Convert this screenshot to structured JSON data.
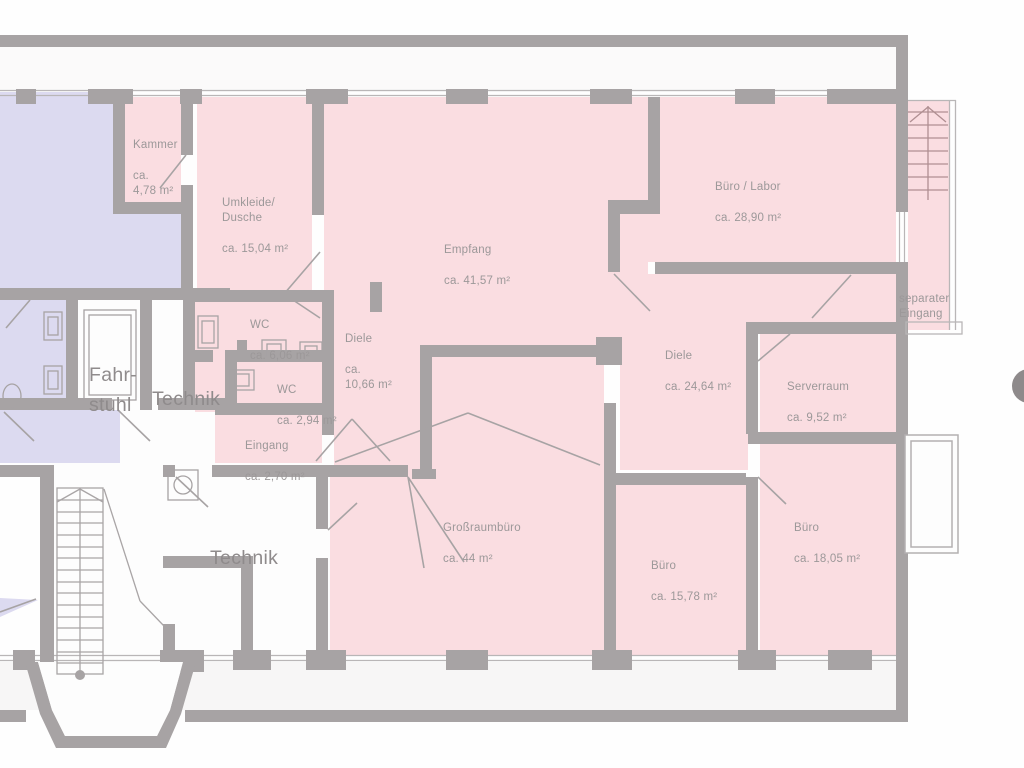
{
  "plan": {
    "type": "floor-plan",
    "language": "de",
    "highlight_note": "pink rooms = offered unit, lavender rooms = neighbouring unit, white rooms = common areas"
  },
  "colors": {
    "unit_pink": "#fadde1",
    "neighbour_lavender": "#dcdaf0",
    "wall_gray": "#a7a3a4",
    "thin_line_gray": "#b9b6b7",
    "terrace_gray": "#f7f6f6",
    "label_gray": "#9c9899",
    "big_label_gray": "#8f8b8c",
    "compass_gray": "#8e8a8b"
  },
  "rooms": [
    {
      "id": "kammer",
      "name": "Kammer",
      "area": "ca.\n4,78 m²"
    },
    {
      "id": "umkleide-dusche",
      "name": "Umkleide/\nDusche",
      "area": "ca. 15,04 m²"
    },
    {
      "id": "empfang",
      "name": "Empfang",
      "area": "ca. 41,57 m²"
    },
    {
      "id": "buero-labor",
      "name": "Büro / Labor",
      "area": "ca. 28,90 m²"
    },
    {
      "id": "wc-gross",
      "name": "WC",
      "area": "ca. 6,06 m²"
    },
    {
      "id": "diele-klein",
      "name": "Diele",
      "area": "ca.\n10,66 m²"
    },
    {
      "id": "wc-klein",
      "name": "WC",
      "area": "ca. 2,94 m²"
    },
    {
      "id": "eingang",
      "name": "Eingang",
      "area": "ca. 2,70 m²"
    },
    {
      "id": "diele-gross",
      "name": "Diele",
      "area": "ca. 24,64 m²"
    },
    {
      "id": "serverraum",
      "name": "Serverraum",
      "area": "ca. 9,52 m²"
    },
    {
      "id": "grossraumbuero",
      "name": "Großraumbüro",
      "area": "ca. 44 m²"
    },
    {
      "id": "buero-mitte",
      "name": "Büro",
      "area": "ca. 15,78 m²"
    },
    {
      "id": "buero-rechts",
      "name": "Büro",
      "area": "ca. 18,05 m²"
    },
    {
      "id": "separater-eingang",
      "name": "separater\nEingang",
      "area": ""
    },
    {
      "id": "fahrstuhl",
      "name": "Fahr-\nstuhl",
      "area": ""
    },
    {
      "id": "technik-oben",
      "name": "Technik",
      "area": ""
    },
    {
      "id": "technik-unten",
      "name": "Technik",
      "area": ""
    }
  ]
}
